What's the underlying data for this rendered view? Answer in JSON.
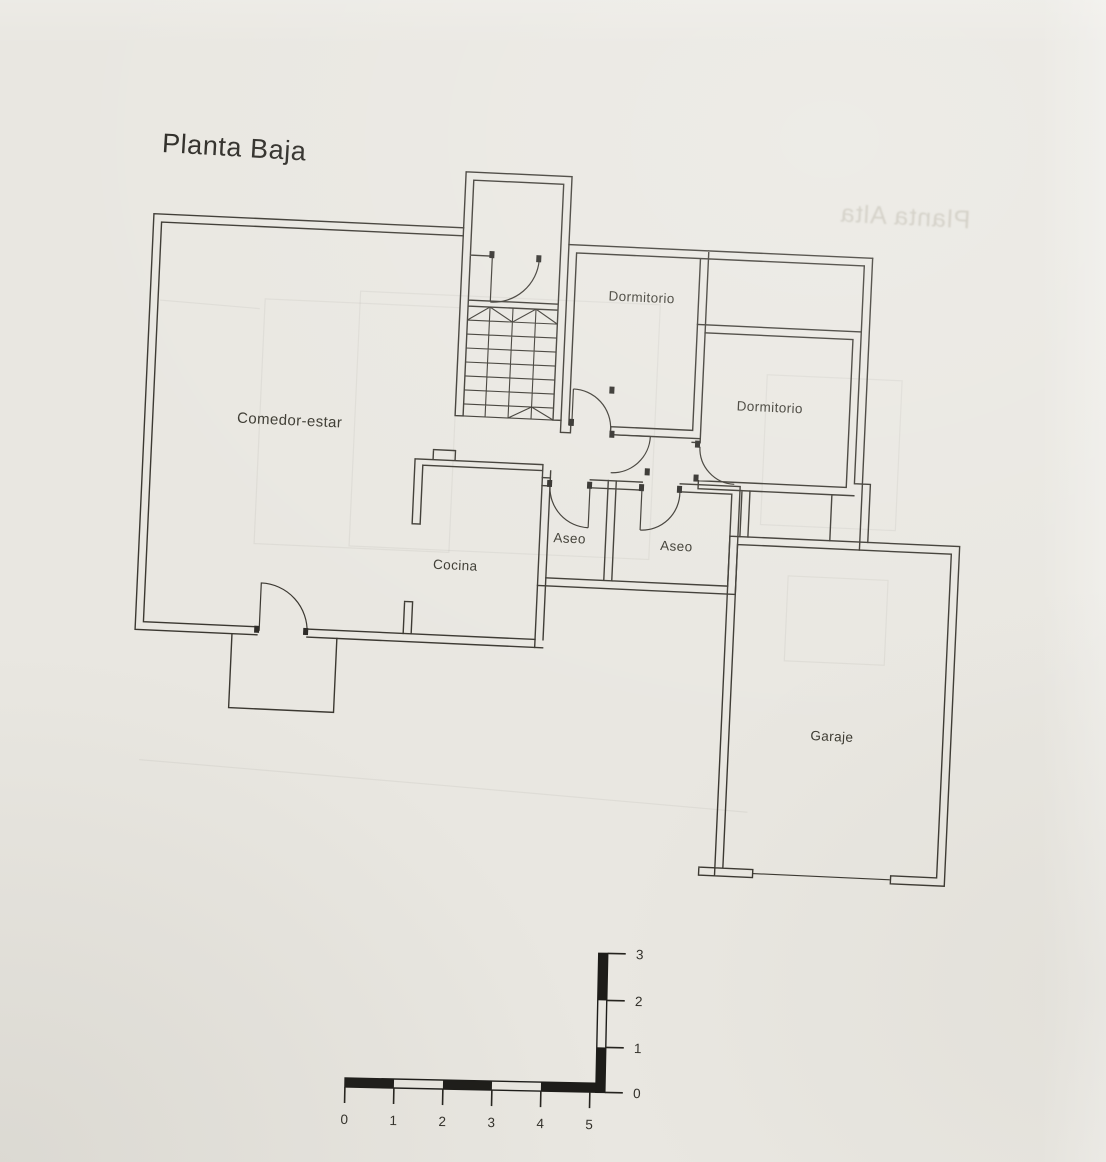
{
  "document": {
    "title": "Planta Baja",
    "bleed_through_text": "Planta Alta"
  },
  "rooms": [
    {
      "id": "comedor-estar",
      "label": "Comedor-estar"
    },
    {
      "id": "dormitorio-top",
      "label": "Dormitorio"
    },
    {
      "id": "dormitorio-right",
      "label": "Dormitorio"
    },
    {
      "id": "cocina",
      "label": "Cocina"
    },
    {
      "id": "aseo-left",
      "label": "Aseo"
    },
    {
      "id": "aseo-right",
      "label": "Aseo"
    },
    {
      "id": "garaje",
      "label": "Garaje"
    }
  ],
  "scale_bar": {
    "horizontal_labels": [
      "0",
      "1",
      "2",
      "3",
      "4",
      "5"
    ],
    "vertical_labels": [
      "0",
      "1",
      "2",
      "3"
    ]
  },
  "colors": {
    "paper": "#e9e7e1",
    "ink": "#3b3831",
    "scale_bar": "#1d1c19"
  }
}
